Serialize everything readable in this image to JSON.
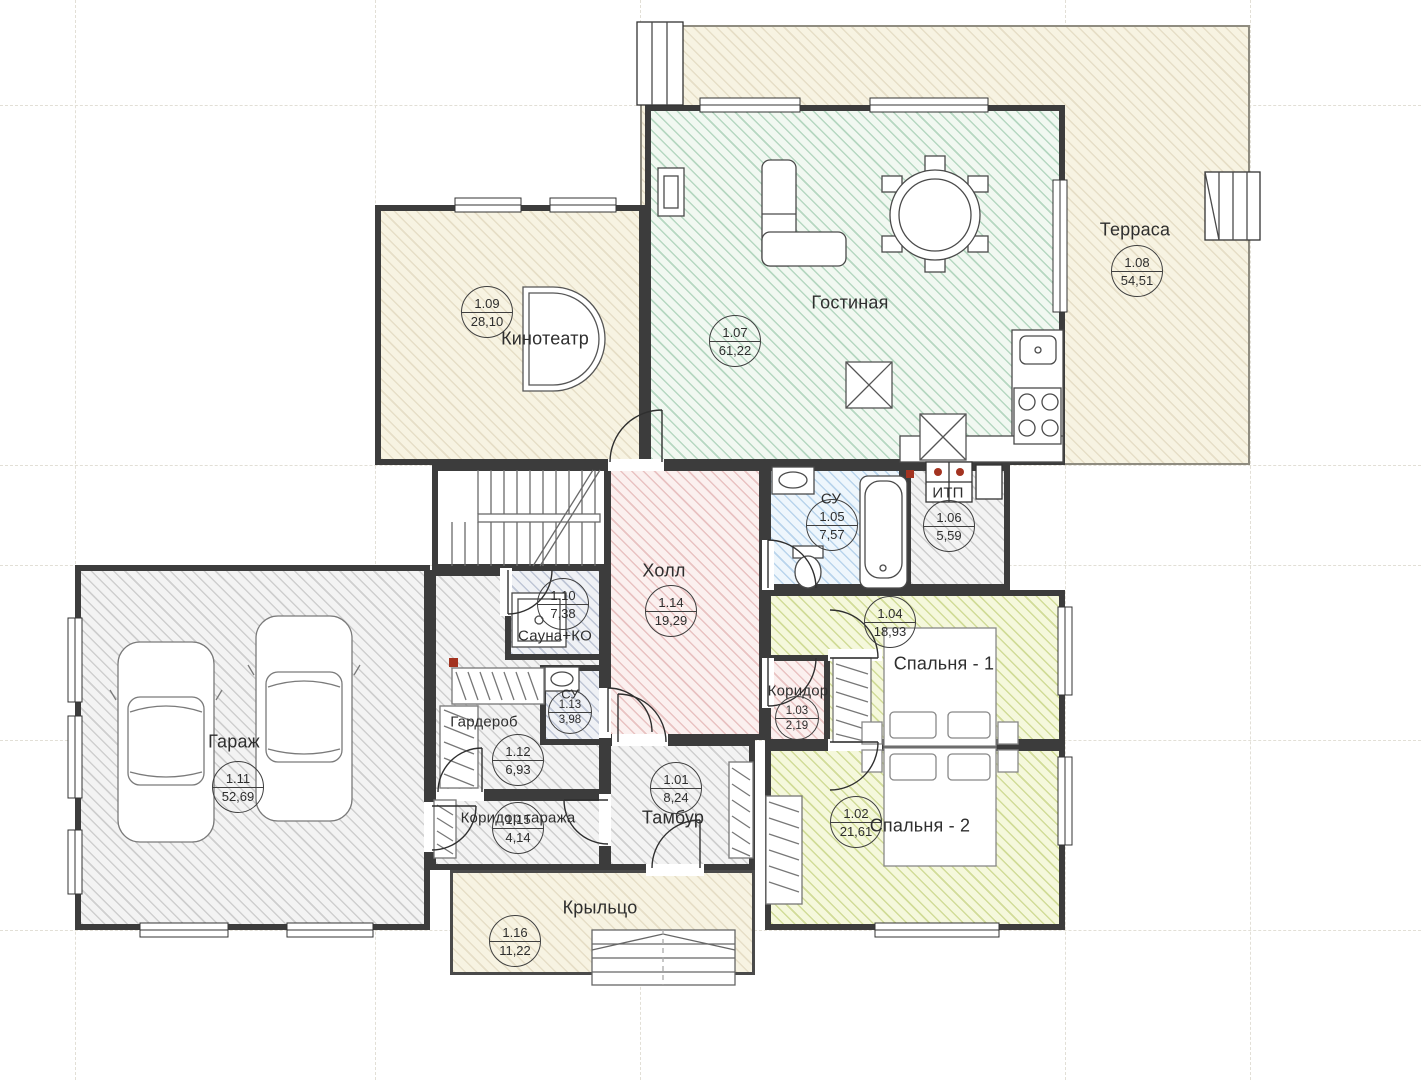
{
  "plan": {
    "title": "First floor plan",
    "rooms": [
      {
        "number": "1.01",
        "label": "Тамбур",
        "area": "8,24"
      },
      {
        "number": "1.02",
        "label": "Спальня - 2",
        "area": "21,61"
      },
      {
        "number": "1.03",
        "label": "Коридор",
        "area": "2,19"
      },
      {
        "number": "1.04",
        "label": "Спальня - 1",
        "area": "18,93"
      },
      {
        "number": "1.05",
        "label": "СУ",
        "area": "7,57"
      },
      {
        "number": "1.06",
        "label": "ИТП",
        "area": "5,59"
      },
      {
        "number": "1.07",
        "label": "Гостиная",
        "area": "61,22"
      },
      {
        "number": "1.08",
        "label": "Терраса",
        "area": "54,51"
      },
      {
        "number": "1.09",
        "label": "Кинотеатр",
        "area": "28,10"
      },
      {
        "number": "1.10",
        "label": "Сауна+КО",
        "area": "7,38"
      },
      {
        "number": "1.11",
        "label": "Гараж",
        "area": "52,69"
      },
      {
        "number": "1.12",
        "label": "Гардероб",
        "area": "6,93"
      },
      {
        "number": "1.13",
        "label": "СУ",
        "area": "3,98"
      },
      {
        "number": "1.14",
        "label": "Холл",
        "area": "19,29"
      },
      {
        "number": "1.15",
        "label": "Коридор гаража",
        "area": "4,14"
      },
      {
        "number": "1.16",
        "label": "Крыльцо",
        "area": "11,22"
      }
    ],
    "palette": {
      "wall": "#3c3c3c",
      "terrace_fill": "#f7f3e2",
      "living_fill": "#f1f8f1",
      "hall_fill": "#fbf0ef",
      "bathroom_fill": "#eef6fc",
      "tech_fill": "#f3f3f3",
      "bedroom_fill": "#f5f8dc",
      "sauna_fill": "#eff1f5",
      "equipment_red": "#a33320"
    }
  }
}
